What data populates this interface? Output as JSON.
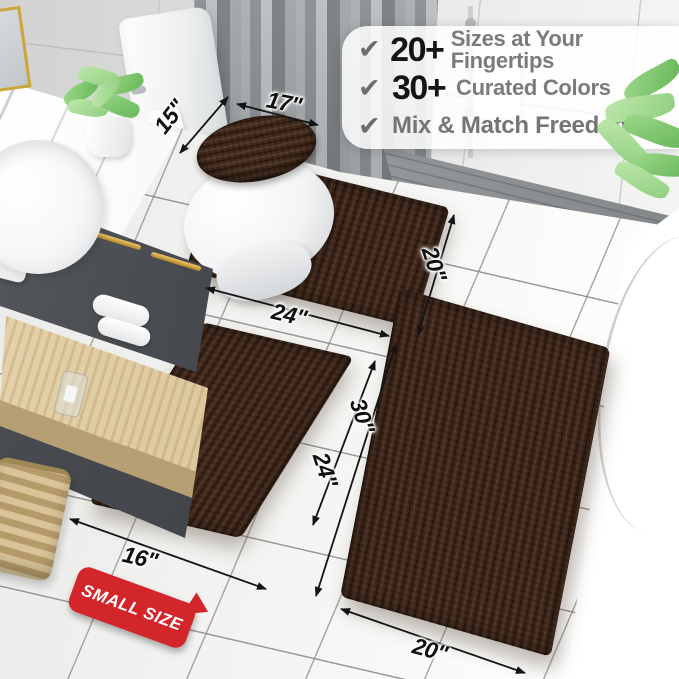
{
  "features": {
    "row1": {
      "check": "✔",
      "stat": "20+",
      "label": "Sizes at Your Fingertips"
    },
    "row2": {
      "check": "✔",
      "stat": "30+",
      "label": "Curated Colors"
    },
    "row3": {
      "check": "✔",
      "label": "Mix & Match Freedom"
    }
  },
  "dimensions": {
    "lid_top": "17\"",
    "lid_side": "15\"",
    "contour_bottom": "24\"",
    "contour_side": "20\"",
    "small_bottom": "16\"",
    "small_side": "24\"",
    "large_side": "30\"",
    "large_bottom": "20\""
  },
  "badge": {
    "label": "SMALL SIZE"
  },
  "colors": {
    "rug_brown": "#43291B",
    "badge_red": "#D2262B",
    "gold_accent": "#C9A53A",
    "leaf_green": "#8CCE7C",
    "check_gray": "#6D6D6D"
  }
}
